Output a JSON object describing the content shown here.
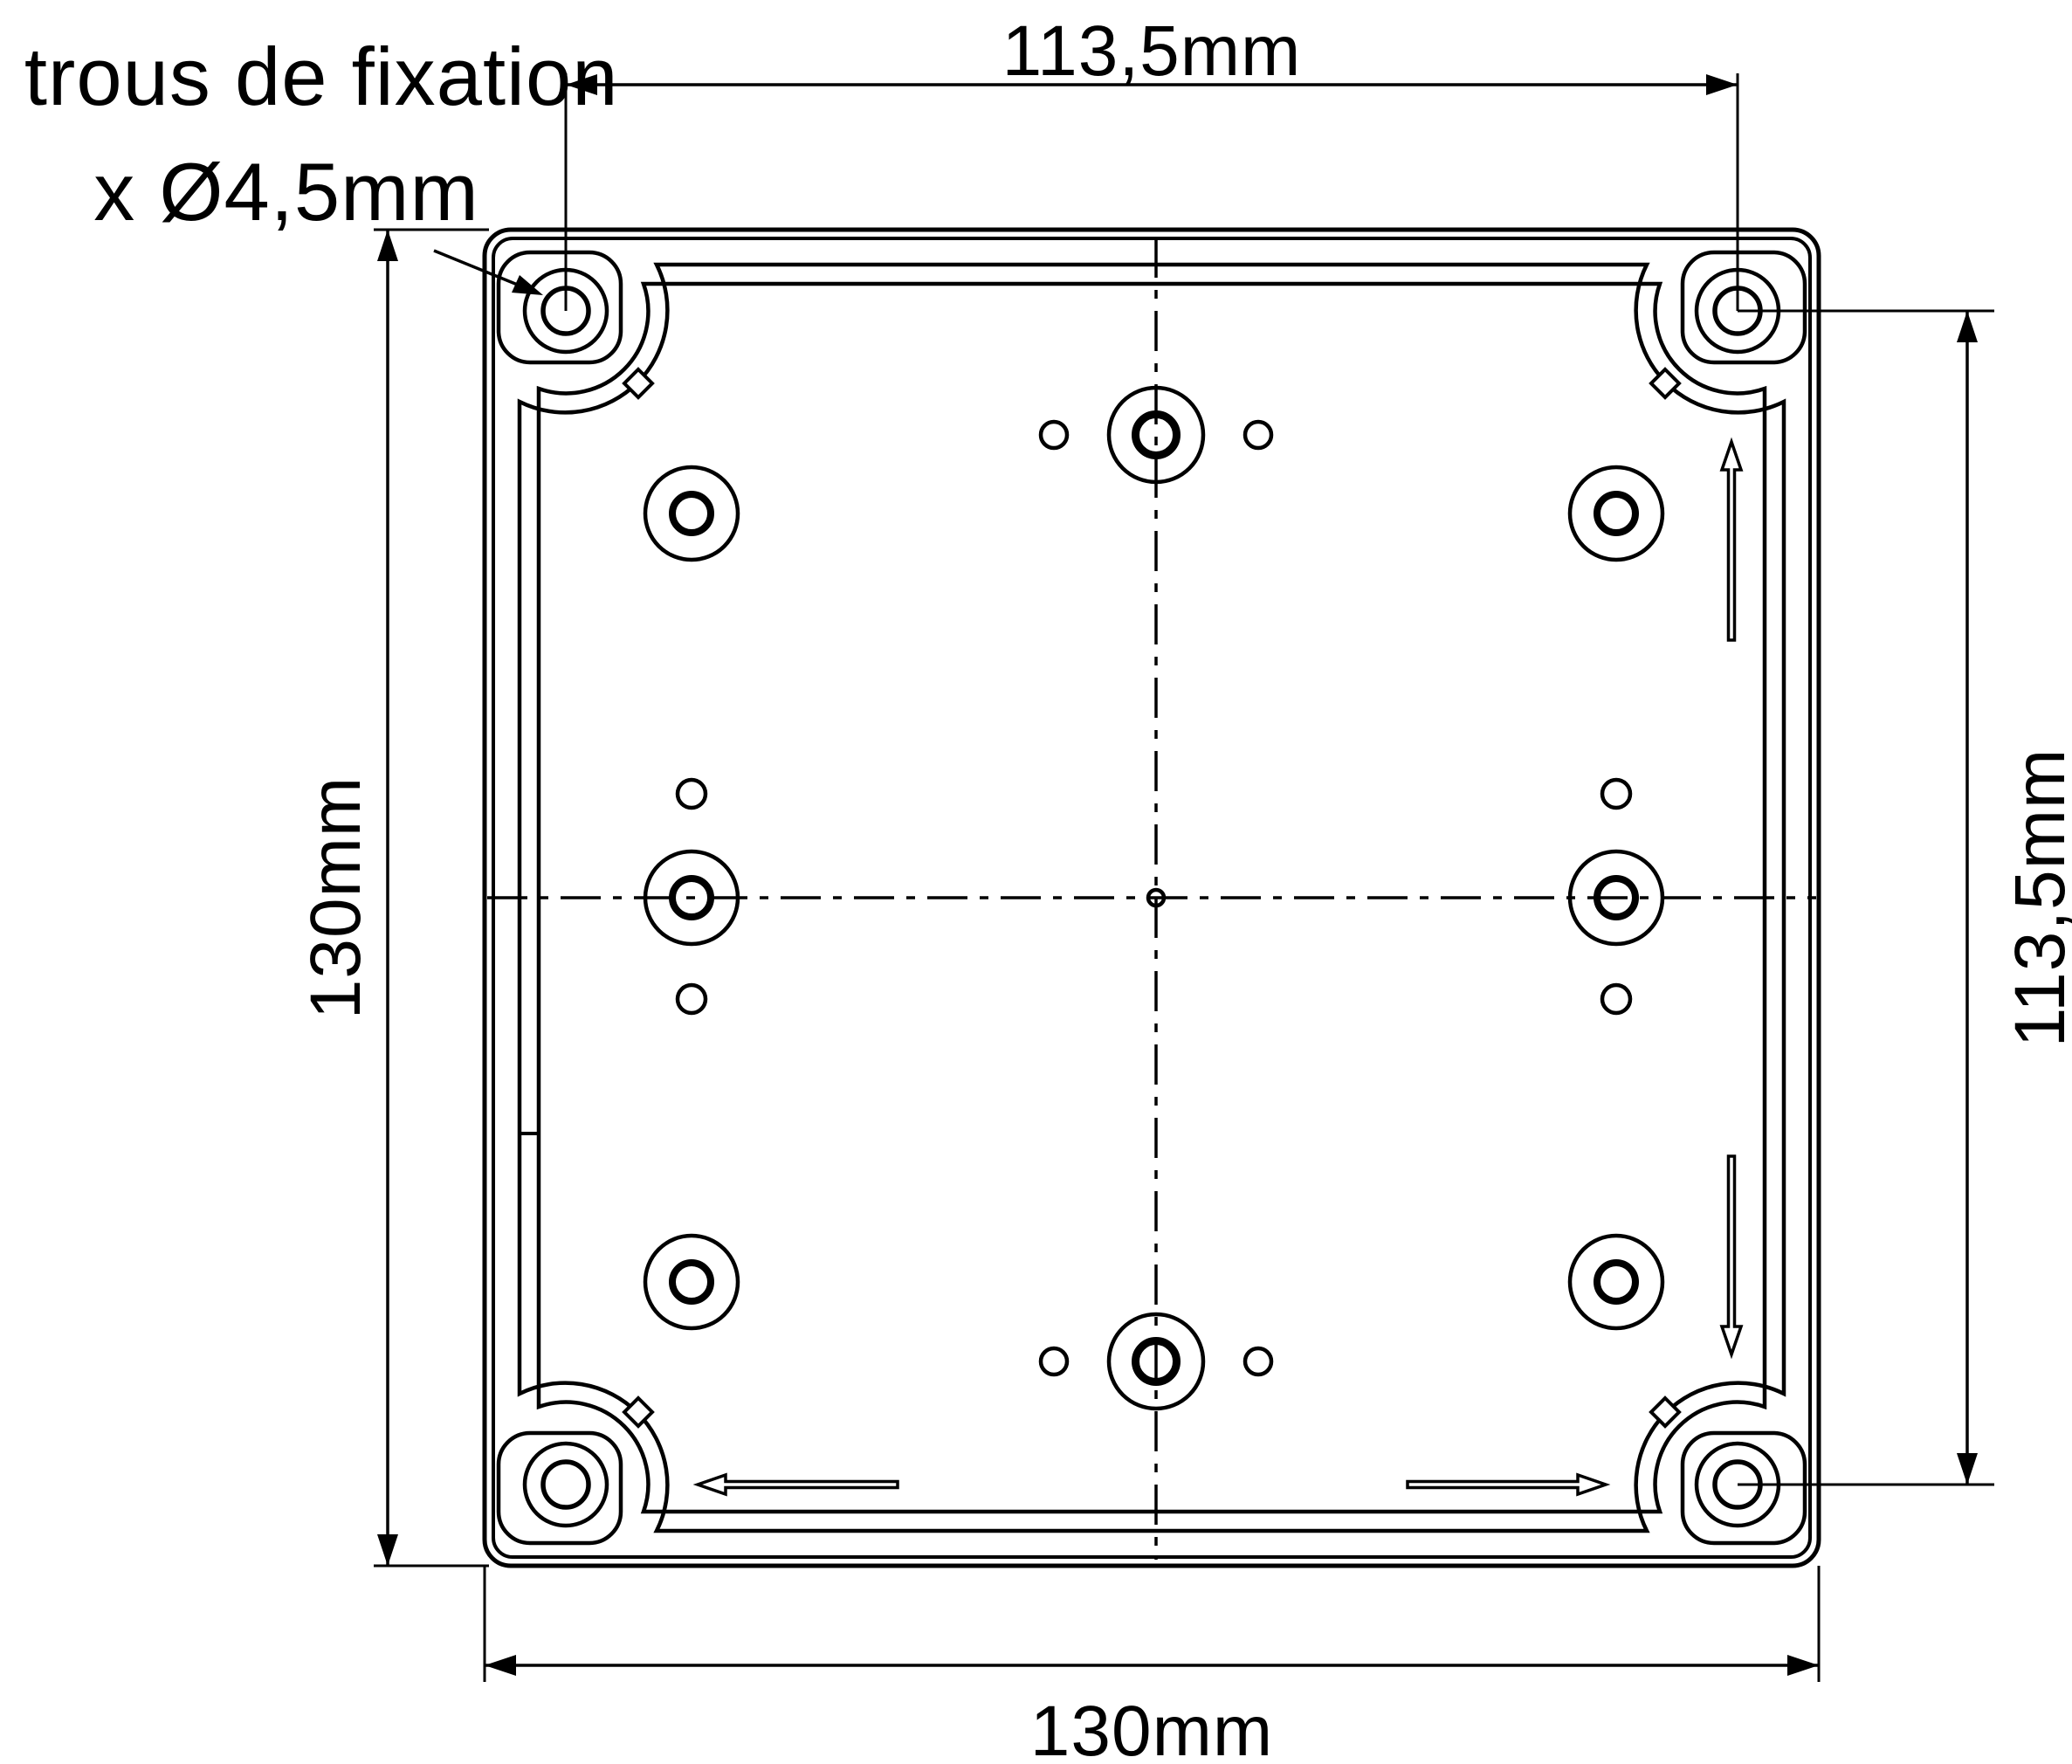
{
  "drawing": {
    "note": {
      "line1": "4 trous de fixation",
      "line2": "x Ø4,5mm"
    },
    "dimensions": {
      "top": {
        "label": "113,5mm"
      },
      "right": {
        "label": "113,5mm"
      },
      "left": {
        "label": "130mm"
      },
      "bottom": {
        "label": "130mm"
      }
    },
    "colors": {
      "line": "#000000",
      "background": "#ffffff"
    }
  }
}
